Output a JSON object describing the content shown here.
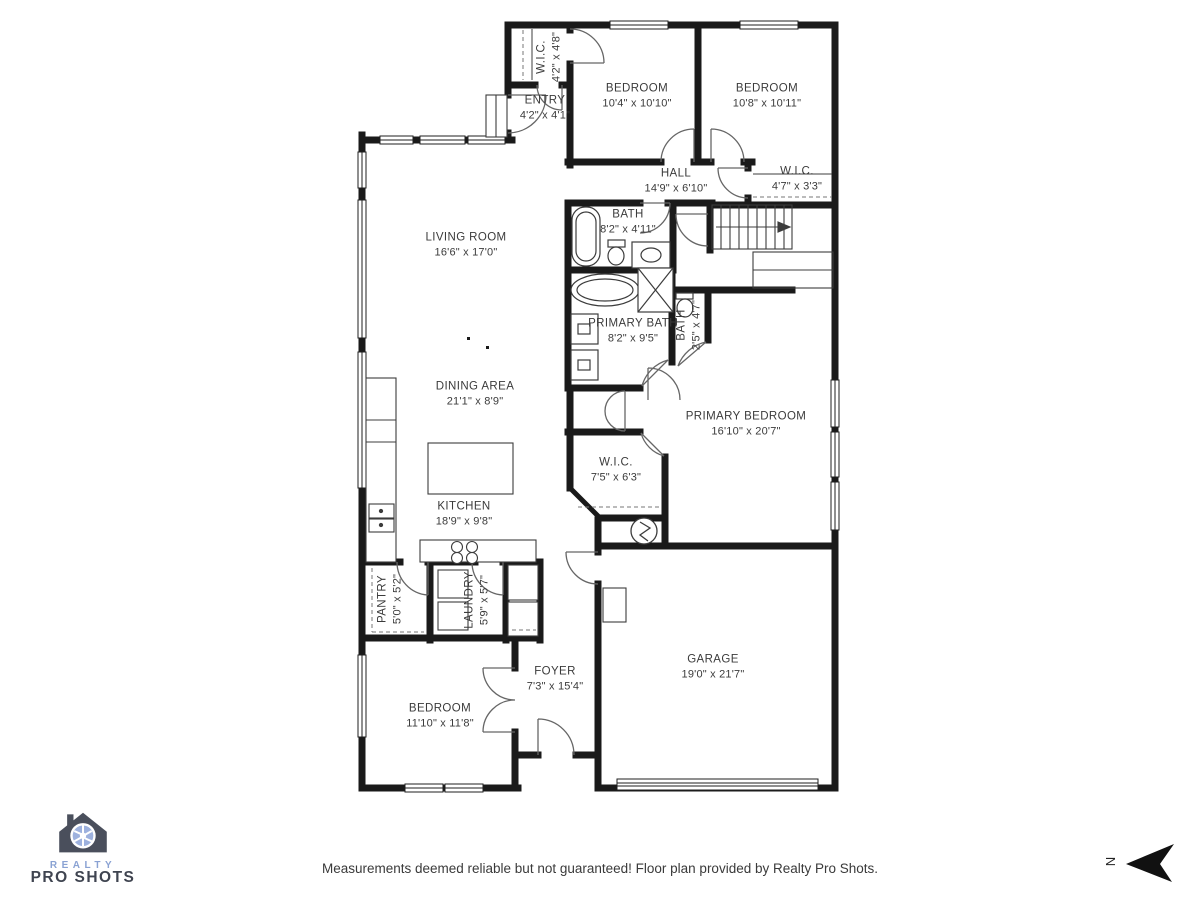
{
  "floor_plan": {
    "rooms": [
      {
        "id": "wic-entry",
        "name": "W.I.C.",
        "dims": "4'2\" x 4'8\""
      },
      {
        "id": "entry",
        "name": "ENTRY",
        "dims": "4'2\" x 4'1\""
      },
      {
        "id": "bedroom-a",
        "name": "BEDROOM",
        "dims": "10'4\" x 10'10\""
      },
      {
        "id": "bedroom-b",
        "name": "BEDROOM",
        "dims": "10'8\" x 10'11\""
      },
      {
        "id": "hall",
        "name": "HALL",
        "dims": "14'9\" x 6'10\""
      },
      {
        "id": "wic-hall",
        "name": "W.I.C.",
        "dims": "4'7\" x 3'3\""
      },
      {
        "id": "bath",
        "name": "BATH",
        "dims": "8'2\" x 4'11\""
      },
      {
        "id": "living-room",
        "name": "LIVING ROOM",
        "dims": "16'6\" x 17'0\""
      },
      {
        "id": "primary-bath",
        "name": "PRIMARY BATH",
        "dims": "8'2\" x 9'5\""
      },
      {
        "id": "bath-small",
        "name": "BATH",
        "dims": "2'5\" x 4'7\""
      },
      {
        "id": "dining-area",
        "name": "DINING AREA",
        "dims": "21'1\" x 8'9\""
      },
      {
        "id": "primary-bedroom",
        "name": "PRIMARY BEDROOM",
        "dims": "16'10\" x 20'7\""
      },
      {
        "id": "wic-primary",
        "name": "W.I.C.",
        "dims": "7'5\" x 6'3\""
      },
      {
        "id": "kitchen",
        "name": "KITCHEN",
        "dims": "18'9\" x 9'8\""
      },
      {
        "id": "pantry",
        "name": "PANTRY",
        "dims": "5'0\" x 5'2\""
      },
      {
        "id": "laundry",
        "name": "LAUNDRY",
        "dims": "5'9\" x 5'7\""
      },
      {
        "id": "bedroom-c",
        "name": "BEDROOM",
        "dims": "11'10\" x 11'8\""
      },
      {
        "id": "foyer",
        "name": "FOYER",
        "dims": "7'3\" x 15'4\""
      },
      {
        "id": "garage",
        "name": "GARAGE",
        "dims": "19'0\" x 21'7\""
      }
    ],
    "footer": "Measurements deemed reliable but not guaranteed! Floor plan provided by Realty Pro Shots.",
    "logo": {
      "line1": "REALTY",
      "line2": "PRO SHOTS"
    },
    "compass": {
      "label": "N"
    },
    "colors": {
      "wall": "#1a1a1a",
      "door": "#666666",
      "logo_blue": "#8aa2d3",
      "logo_dark": "#3f4450"
    }
  }
}
